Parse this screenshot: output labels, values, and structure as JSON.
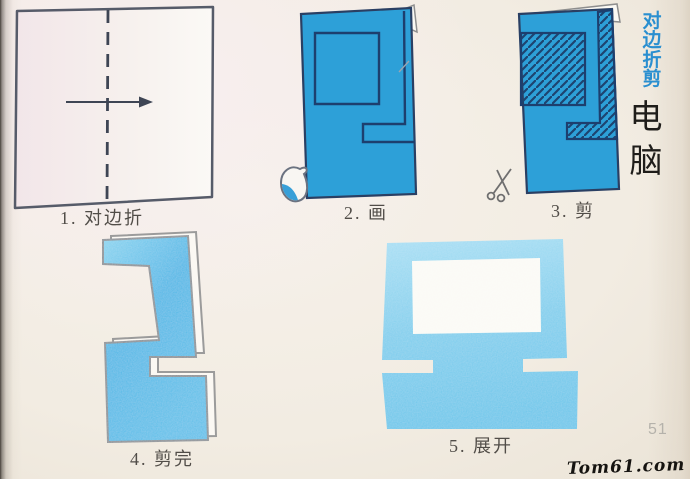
{
  "page": {
    "side_caption": "对边折剪",
    "title": "电脑",
    "page_number": "51",
    "watermark": "Tom61.com"
  },
  "steps": [
    {
      "label": "1. 对边折"
    },
    {
      "label": "2. 画"
    },
    {
      "label": "3. 剪"
    },
    {
      "label": "4. 剪完"
    },
    {
      "label": "5. 展开"
    }
  ],
  "icons": {
    "draw_tool": "pen-nib-icon",
    "cut_tool": "scissors-icon"
  },
  "colors": {
    "folded_paper_blue": "#2da0d8",
    "pattern_outline_navy": "#1d3f6e",
    "cut_paper_blue": "#4db7e6",
    "unfolded_paper_blue": "#7fceed",
    "caption_blue": "#2a8fd0",
    "page_background": "#f2ece2"
  }
}
